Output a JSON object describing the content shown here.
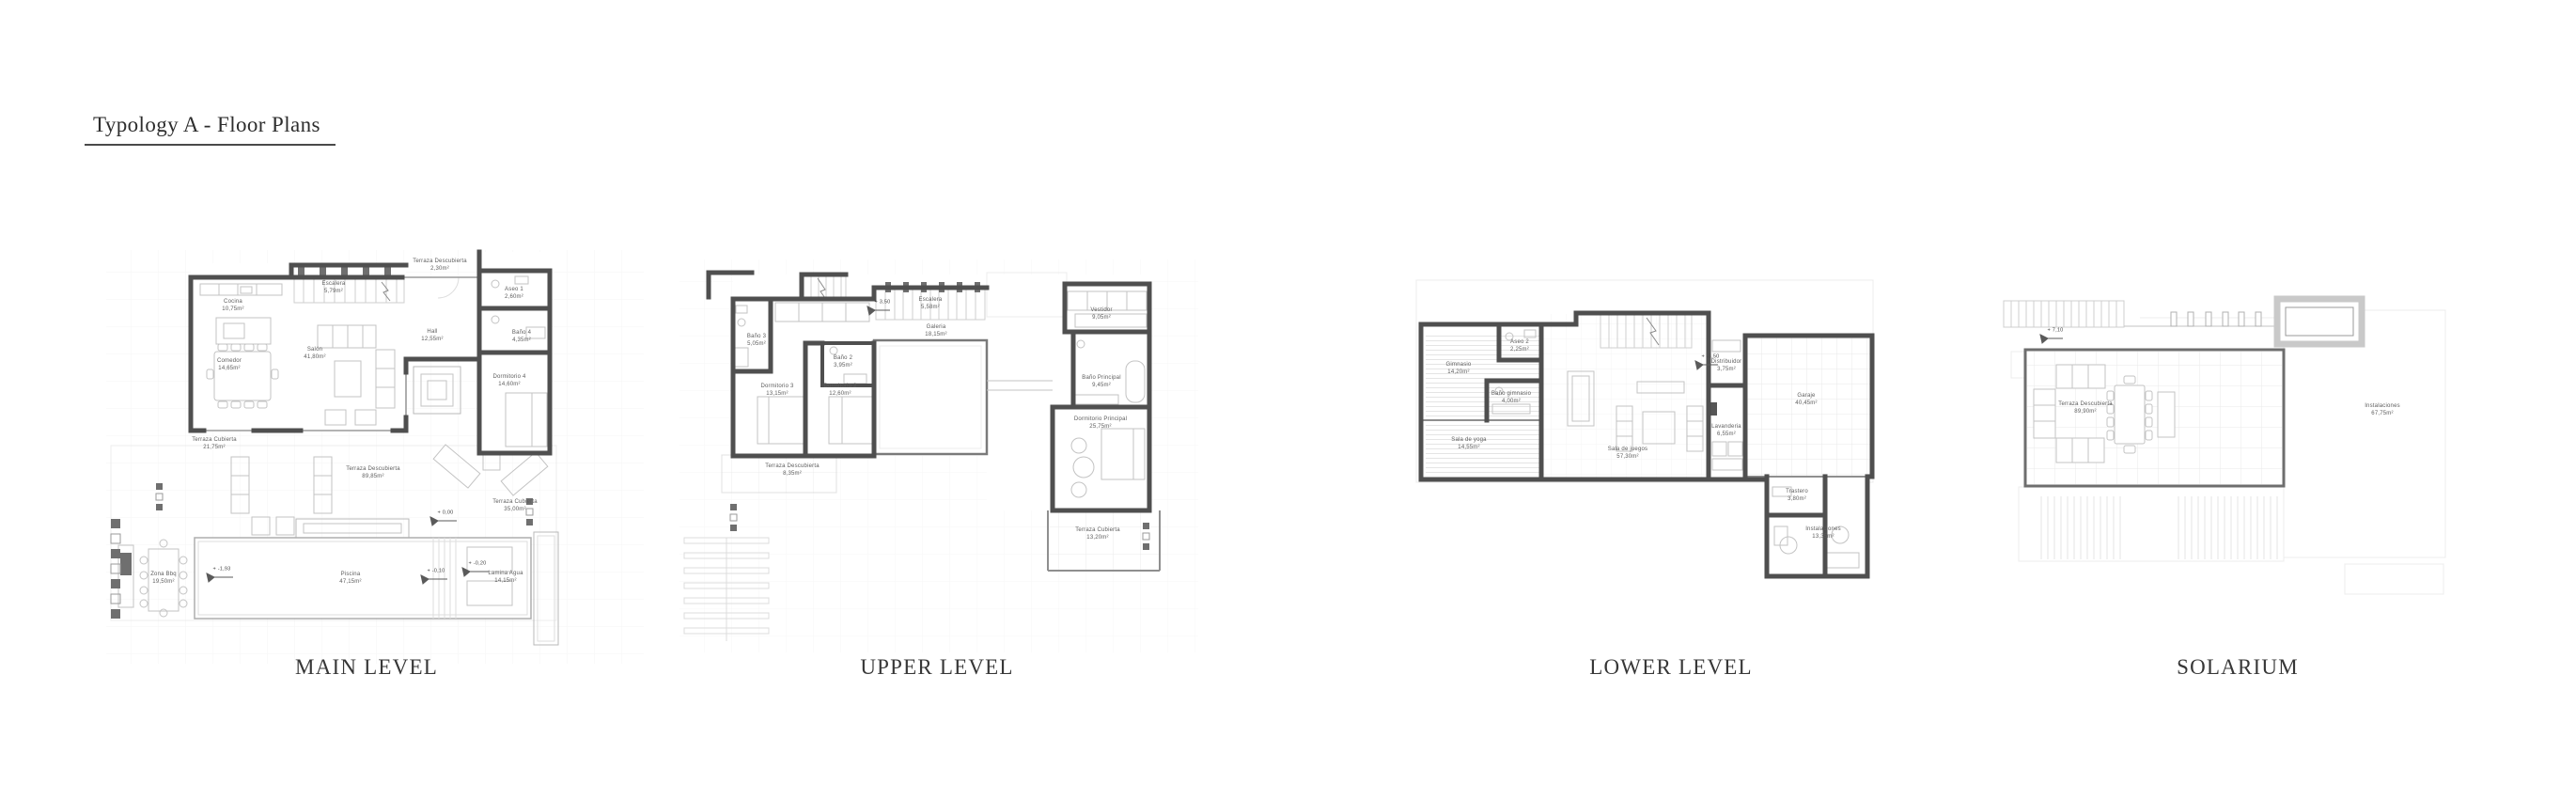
{
  "title": "Typology A - Floor Plans",
  "colors": {
    "wall": "#4f4f4f",
    "detail_line": "#c3c3c3",
    "label_text": "#5d5d5d"
  },
  "plans": [
    {
      "caption": "MAIN LEVEL",
      "rooms": [
        {
          "name": "Cocina",
          "area": "10,75m²"
        },
        {
          "name": "Escalera",
          "area": "5,79m²"
        },
        {
          "name": "Terraza Descubierta",
          "area": "2,30m²"
        },
        {
          "name": "Aseo 1",
          "area": "2,60m²"
        },
        {
          "name": "Hall",
          "area": "12,55m²"
        },
        {
          "name": "Baño 4",
          "area": "4,35m²"
        },
        {
          "name": "Comedor",
          "area": "14,65m²"
        },
        {
          "name": "Salón",
          "area": "41,80m²"
        },
        {
          "name": "Dormitorio 4",
          "area": "14,60m²"
        },
        {
          "name": "Terraza Cubierta",
          "area": "21,75m²"
        },
        {
          "name": "Terraza Descubierta",
          "area": "89,85m²"
        },
        {
          "name": "Terraza Cubierta",
          "area": "35,00m²"
        },
        {
          "name": "Zona Bbq",
          "area": "19,50m²"
        },
        {
          "name": "Piscina",
          "area": "47,15m²"
        },
        {
          "name": "Lamina Agua",
          "area": "14,15m²"
        }
      ],
      "elevations": [
        {
          "label": "+ 0,00"
        },
        {
          "label": "+ -1,93"
        },
        {
          "label": "+ -0,10"
        },
        {
          "label": "+ -0,20"
        }
      ]
    },
    {
      "caption": "UPPER LEVEL",
      "rooms": [
        {
          "name": "Baño 3",
          "area": "5,05m²"
        },
        {
          "name": "Escalera",
          "area": "5,58m²"
        },
        {
          "name": "Galeria",
          "area": "18,15m²"
        },
        {
          "name": "Vestidor",
          "area": "9,05m²"
        },
        {
          "name": "Baño 2",
          "area": "3,95m²"
        },
        {
          "name": "Dormitorio 3",
          "area": "13,15m²"
        },
        {
          "name": "Dormitorio 2",
          "area": "12,60m²"
        },
        {
          "name": "Baño Principal",
          "area": "9,45m²"
        },
        {
          "name": "Dormitorio Principal",
          "area": "25,75m²"
        },
        {
          "name": "Terraza Descubierta",
          "area": "8,35m²"
        },
        {
          "name": "Terraza Cubierta",
          "area": "13,20m²"
        }
      ],
      "elevations": [
        {
          "label": "+ 3,50"
        }
      ]
    },
    {
      "caption": "LOWER LEVEL",
      "rooms": [
        {
          "name": "Gimnasio",
          "area": "14,20m²"
        },
        {
          "name": "Aseo 2",
          "area": "2,25m²"
        },
        {
          "name": "Baño gimnasio",
          "area": "4,00m²"
        },
        {
          "name": "Sala de yoga",
          "area": "14,55m²"
        },
        {
          "name": "Sala de juegos",
          "area": "57,30m²"
        },
        {
          "name": "Distribuidor",
          "area": "3,75m²"
        },
        {
          "name": "Lavanderia",
          "area": "6,55m²"
        },
        {
          "name": "Garaje",
          "area": "40,45m²"
        },
        {
          "name": "Trastero",
          "area": "3,80m²"
        },
        {
          "name": "Instalaciones",
          "area": "13,35m²"
        }
      ],
      "elevations": [
        {
          "label": "+ -3,50"
        }
      ]
    },
    {
      "caption": "SOLARIUM",
      "rooms": [
        {
          "name": "Terraza Descubierta",
          "area": "89,90m²"
        },
        {
          "name": "Instalaciones",
          "area": "67,75m²"
        }
      ],
      "elevations": [
        {
          "label": "+ 7,10"
        }
      ]
    }
  ]
}
